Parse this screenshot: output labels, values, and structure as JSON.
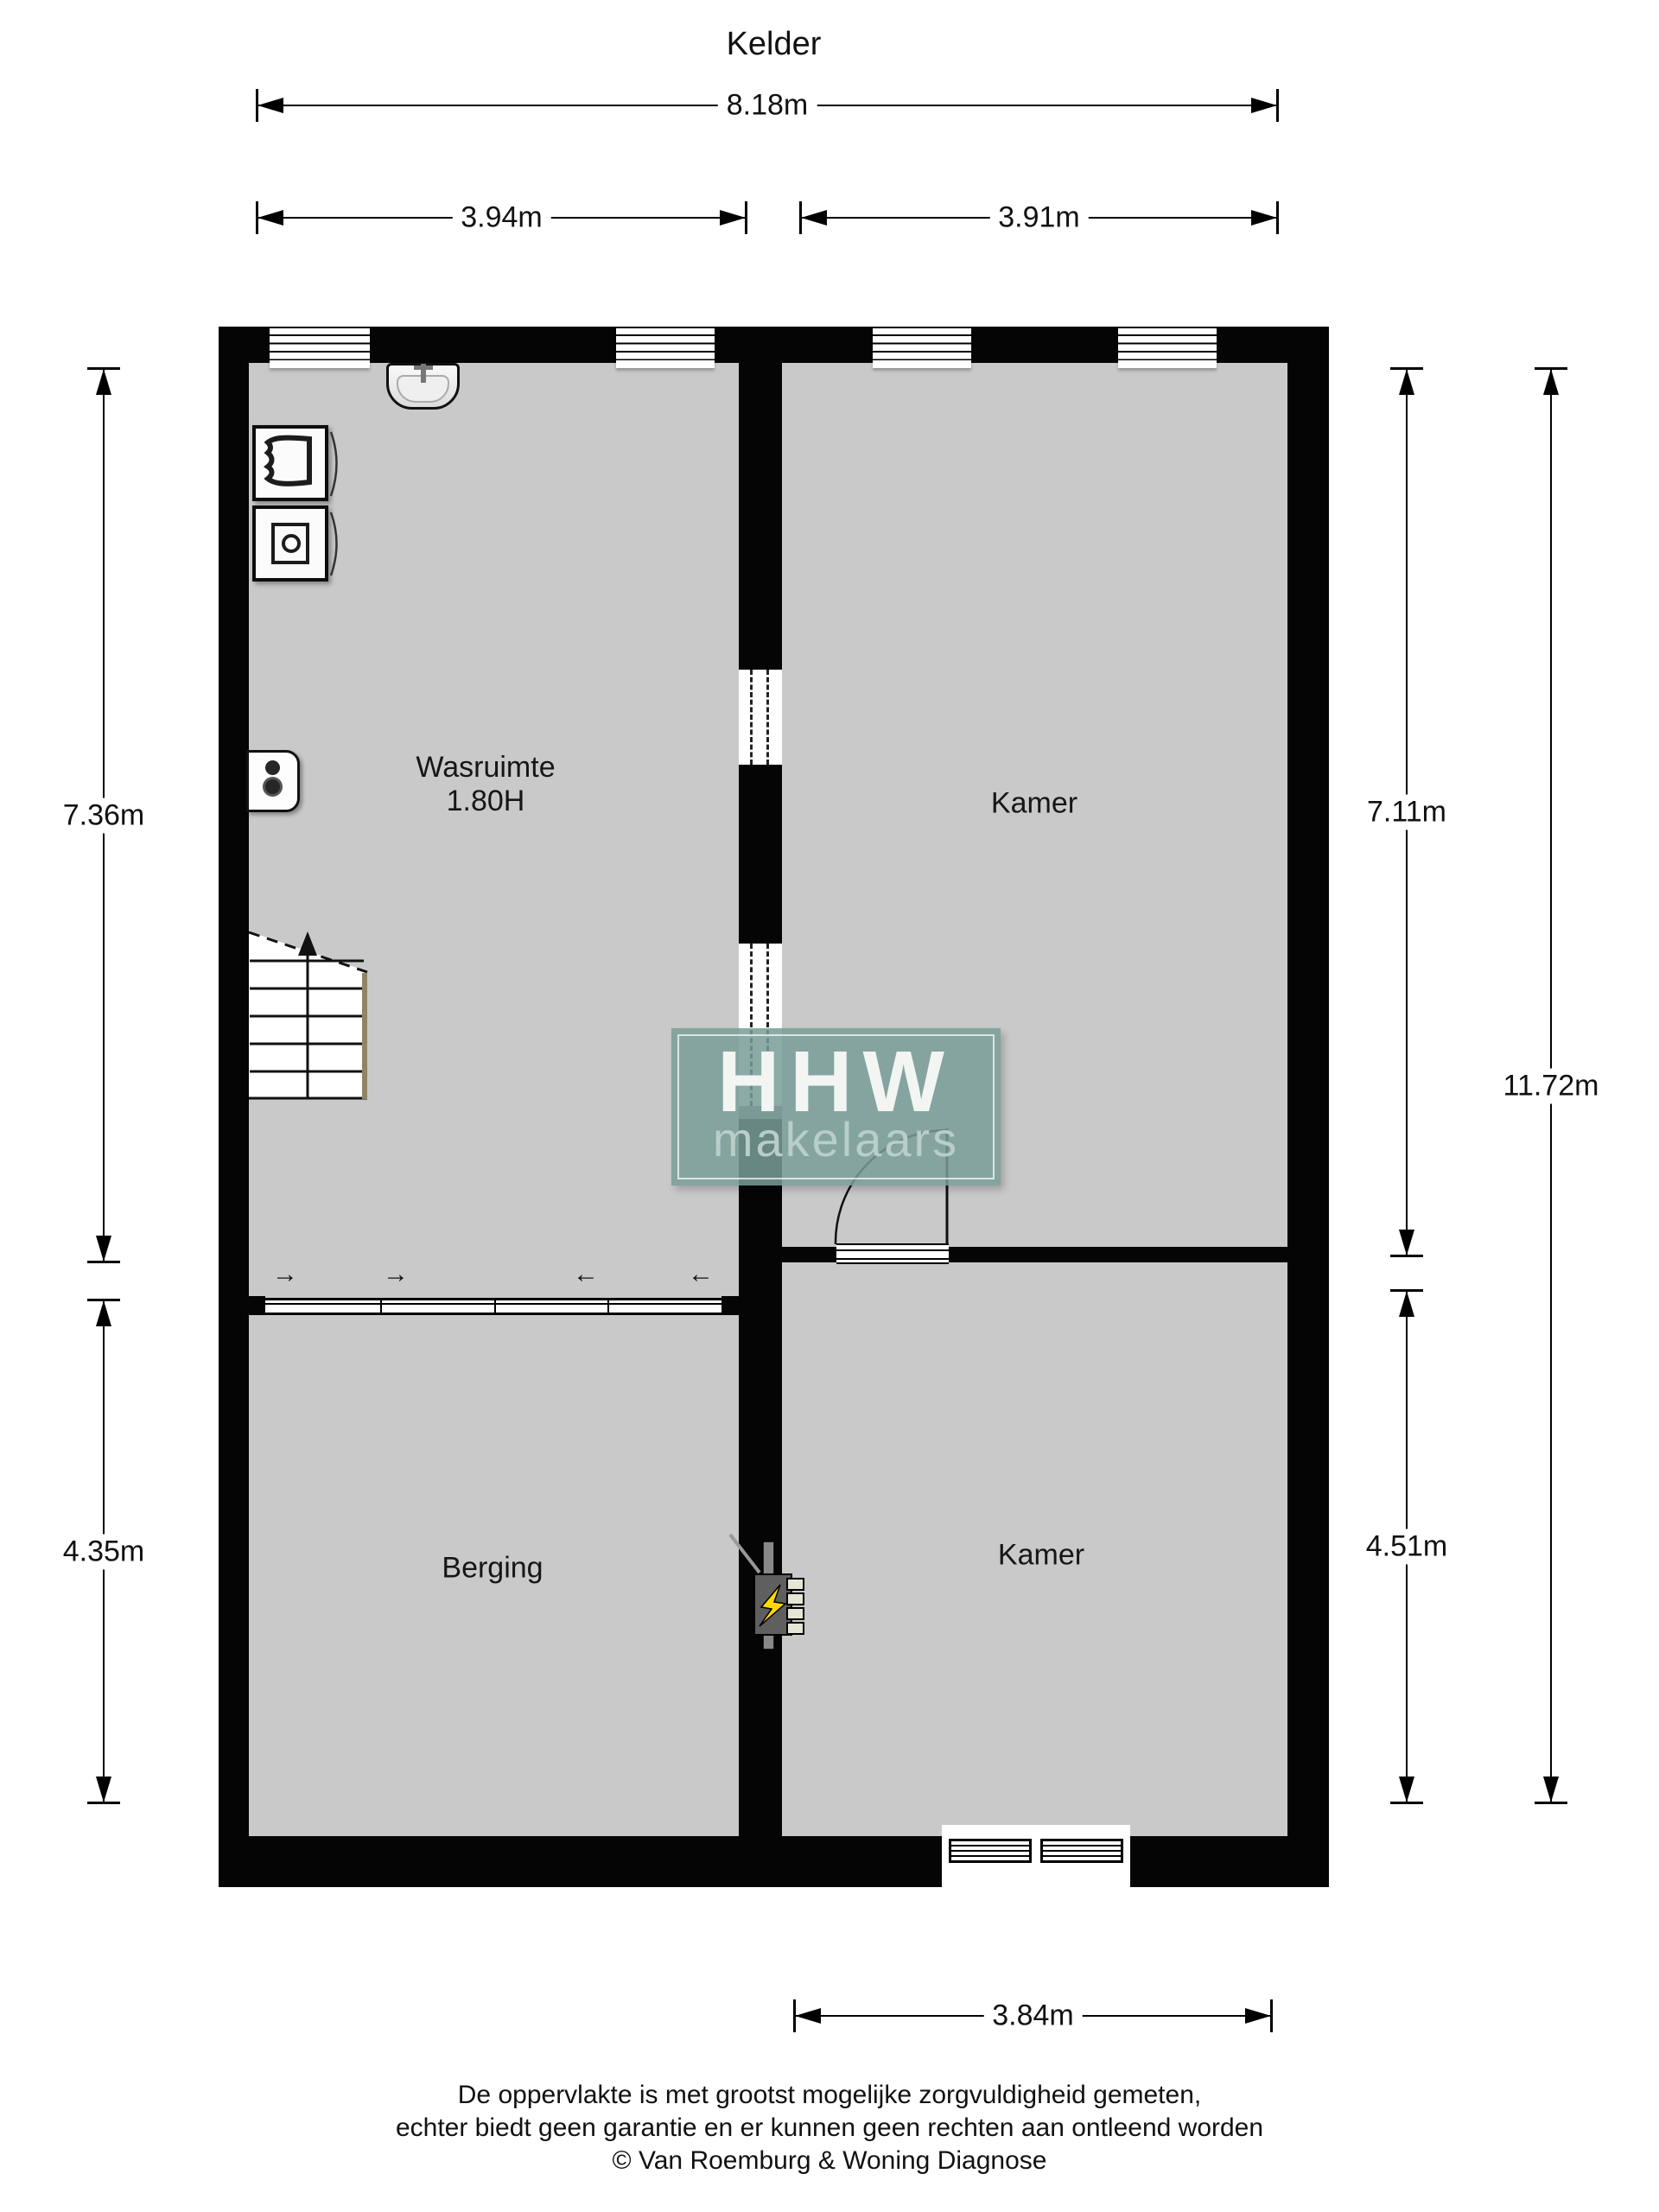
{
  "title": "Kelder",
  "dimensions": {
    "top_total": "8.18m",
    "top_left": "3.94m",
    "top_right": "3.91m",
    "left_upper": "7.36m",
    "left_lower": "4.35m",
    "right_upper": "7.11m",
    "right_lower": "4.51m",
    "right_total": "11.72m",
    "bottom": "3.84m"
  },
  "rooms": {
    "wasruimte": {
      "name": "Wasruimte",
      "height_note": "1.80H"
    },
    "kamer_top": {
      "name": "Kamer"
    },
    "berging": {
      "name": "Berging"
    },
    "kamer_bottom": {
      "name": "Kamer"
    }
  },
  "logo": {
    "line1": "HHW",
    "line2": "makelaars"
  },
  "footer": {
    "line1": "De oppervlakte is met grootst mogelijke zorgvuldigheid gemeten,",
    "line2": "echter biedt geen garantie en er kunnen geen rechten aan ontleend worden",
    "line3": "© Van Roemburg & Woning Diagnose"
  },
  "icons": {
    "slide_arrow_right": "→",
    "slide_arrow_left": "←"
  },
  "colors": {
    "wall": "#050505",
    "floor": "#c9c9c9",
    "logo_bg": "#799d99",
    "logo_title": "#f2f5f2",
    "logo_subtitle": "#b7cec9",
    "lightning": "#ffd900",
    "stair_stringer": "#8f8565"
  }
}
